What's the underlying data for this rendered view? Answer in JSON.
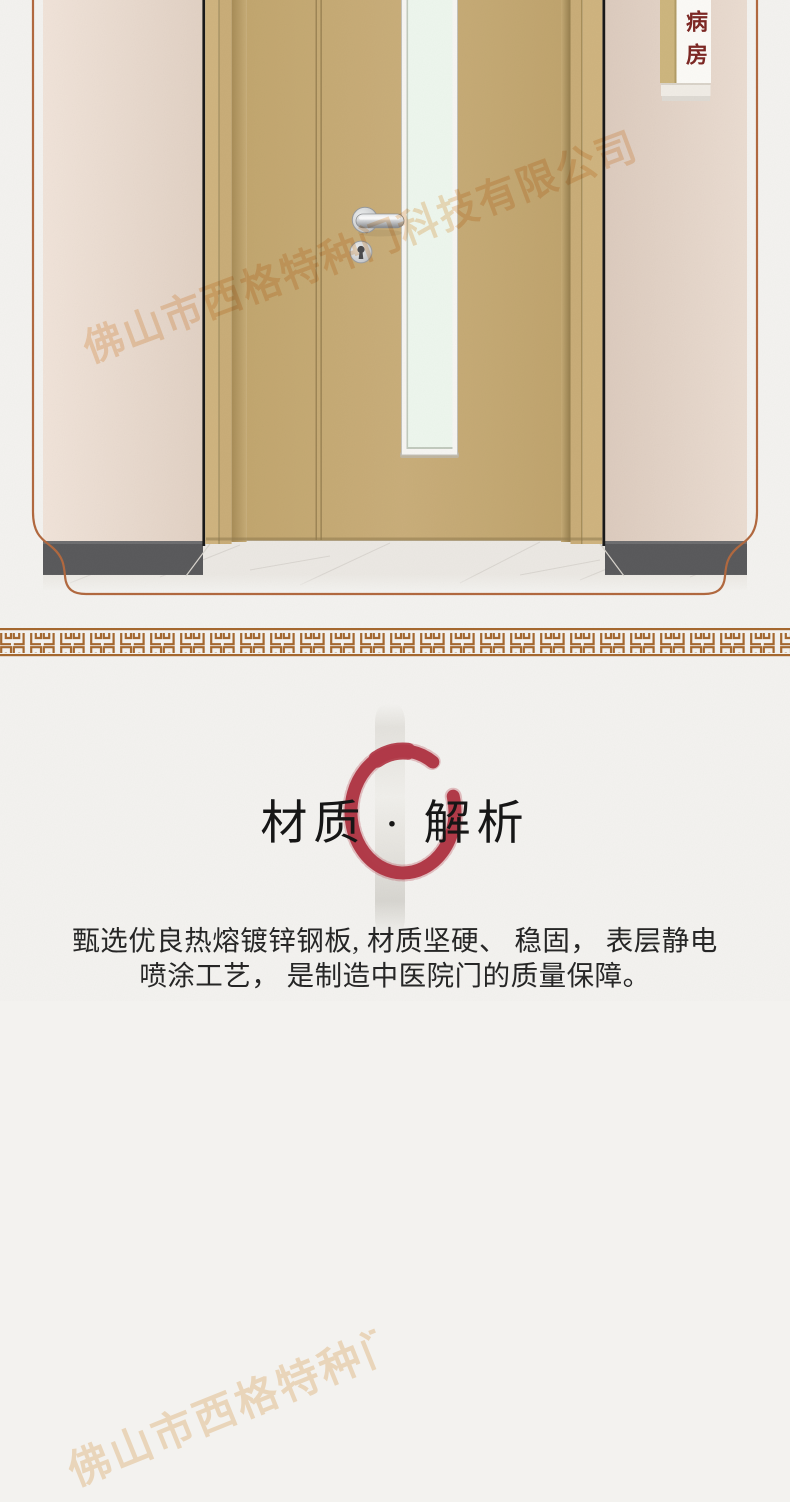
{
  "door_sign": {
    "label": "病房"
  },
  "material_section": {
    "title": "材质 · 解析",
    "description_line1": "甄选优良热熔镀锌钢板, 材质坚硬、 稳固， 表层静电",
    "description_line2": "喷涂工艺， 是制造中医院门的质量保障。"
  },
  "watermark": {
    "company_name": "佛山市西格特种门科技有限公司"
  },
  "decorations": {
    "enso_brush_circle_icon": "red incomplete brush-stroke circle behind title",
    "vertical_brush_stroke": "faint grey ink stroke behind title",
    "meander_border_icon": "brown greek-key / hui-wen repeating band",
    "frame_border": "brown line plaque frame with ogee bottom corners"
  },
  "colors": {
    "page_background": "#f3f2ef",
    "accent_red": "#b23b49",
    "frame_border_brown": "#b2693f",
    "meander_brown": "#a5682f",
    "door_tan": "#c6ab76",
    "wall_pink": "#e7d8cc",
    "glass_green": "#edf6ed",
    "sign_text_red": "#7d2824",
    "baseboard_grey": "#5a5a5c",
    "text_black": "#262626"
  }
}
